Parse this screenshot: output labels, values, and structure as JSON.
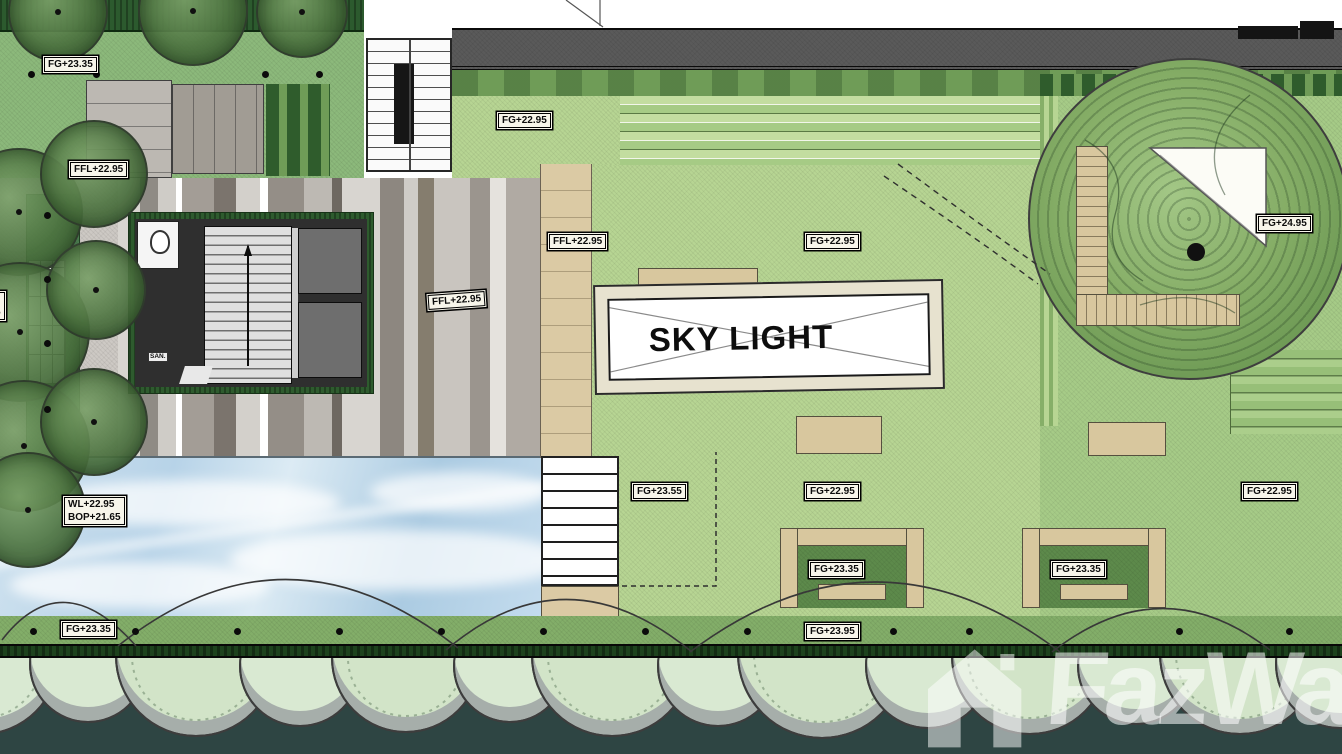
{
  "meta": {
    "type": "architectural landscape site plan"
  },
  "skylight": {
    "label": "SKY LIGHT"
  },
  "watermark": {
    "text": "FazWaz"
  },
  "labels": {
    "fgTopLeft": "FG+23.35",
    "fflTopLeft": "FFL+22.95",
    "fgUpperLawn": "FG+22.95",
    "fflWalkway": "FFL+22.95",
    "fflPaving": "FFL+22.95",
    "fgLawnUpper": "FG+22.95",
    "fgTreeDeck": "FG+24.95",
    "fgStairLawn": "FG+23.55",
    "fgLawnMid": "FG+22.95",
    "fgLawnRight": "FG+22.95",
    "wlPool": "WL+22.95",
    "bopPool": "BOP+21.65",
    "wlEdgeClipped": "WL+22.95",
    "bopEdgeClipped": "BOP+21.65",
    "fgPoolEdge": "FG+23.35",
    "fgPlanterA": "FG+23.35",
    "fgPlanterB": "FG+23.35",
    "fgBottomWalk": "FG+23.95",
    "sanRoom": "SAN."
  },
  "colors": {
    "lawn": "#b7d593",
    "gardenLawn": "#a6cb87",
    "hedgeDark": "#1d421d",
    "asphalt": "#5a5a5a",
    "wood": "#d8c79e",
    "poolBlue": "#b7d3e8",
    "paveLight": "#cdc9c4",
    "slate": "#2e4543",
    "coreDark": "#2f2f2f",
    "white": "#ffffff"
  }
}
